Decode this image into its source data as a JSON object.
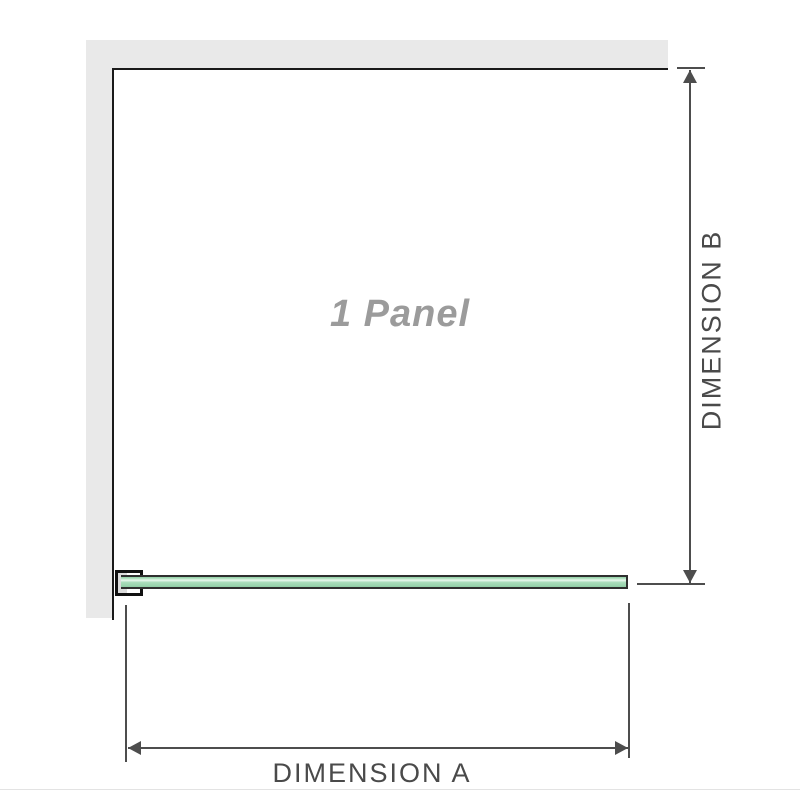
{
  "diagram": {
    "panel_label": "1 Panel",
    "dimension_a_label": "DIMENSION A",
    "dimension_b_label": "DIMENSION B"
  },
  "colors": {
    "wall": "#e9e9e9",
    "panel_outline": "#1a1a1a",
    "dimension_lines": "#4d4d4d",
    "dimension_text": "#4a4a4a",
    "glass_fill": "#a8dcba",
    "glass_highlight": "#eaf7ee",
    "glass_border": "#2f2f2f",
    "panel_label_text": "#9b9b9b",
    "bracket_border": "#111111",
    "bracket_fill": "#ffffff",
    "bracket_shadow": "#dcdcdc"
  },
  "icons": {
    "dimension_b_top": "arrow-up-icon",
    "dimension_b_bottom": "arrow-down-icon",
    "dimension_a_left": "arrow-left-icon",
    "dimension_a_right": "arrow-right-icon"
  }
}
